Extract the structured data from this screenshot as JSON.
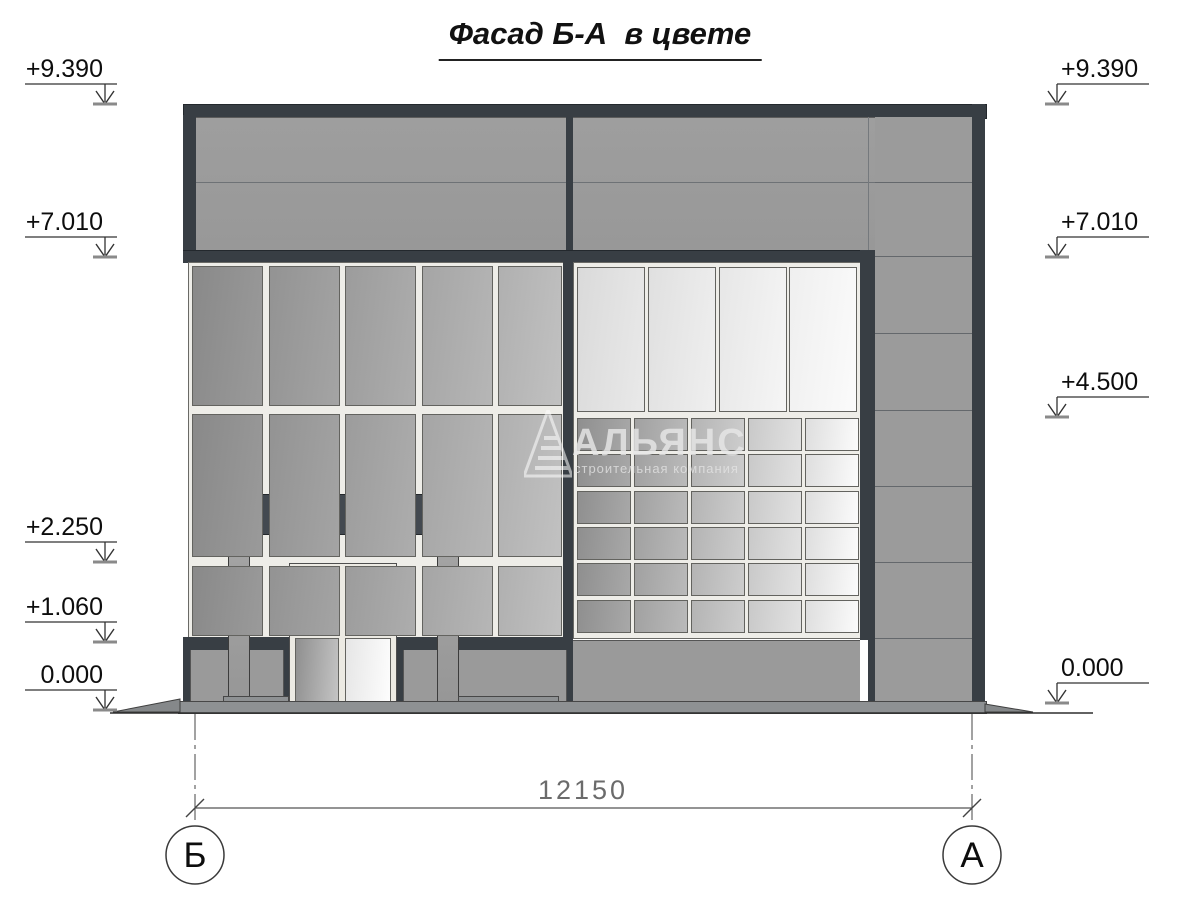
{
  "title": "Фасад Б-А  в цвете",
  "watermark": {
    "name": "АЛЬЯНС",
    "subtitle": "строительная компания"
  },
  "levels_left": [
    {
      "label": "+9.390",
      "y": 104
    },
    {
      "label": "+7.010",
      "y": 257
    },
    {
      "label": "+2.250",
      "y": 562
    },
    {
      "label": "+1.060",
      "y": 642
    },
    {
      "label": "0.000",
      "y": 710
    }
  ],
  "levels_right": [
    {
      "label": "+9.390",
      "y": 104
    },
    {
      "label": "+7.010",
      "y": 257
    },
    {
      "label": "+4.500",
      "y": 417
    },
    {
      "label": "0.000",
      "y": 703
    }
  ],
  "dimension": {
    "value": "12150"
  },
  "axes": [
    {
      "label": "Б",
      "x": 195
    },
    {
      "label": "А",
      "x": 972
    }
  ],
  "palette": {
    "frame_dark": "#383e44",
    "panel_gray": "#9c9c9c",
    "mullion": "#eeede8",
    "glass_white": "#f8f8f8",
    "beam_dark": "#434950",
    "line": "#333333"
  },
  "facade": {
    "left_grid": {
      "cols_x": [
        192,
        268.6,
        345.2,
        421.8,
        498.4
      ],
      "col_w": [
        69,
        69,
        69,
        69,
        62
      ],
      "rows": [
        {
          "y": 266,
          "h": 138
        },
        {
          "y": 414,
          "h": 141
        },
        {
          "y": 566,
          "h": 68
        }
      ],
      "col_colors": [
        [
          "#898989",
          "#9a9a9a"
        ],
        [
          "#939393",
          "#a4a4a4"
        ],
        [
          "#9c9c9c",
          "#adadad"
        ],
        [
          "#a5a5a5",
          "#b6b6b6"
        ],
        [
          "#b0b0b0",
          "#c1c1c1"
        ]
      ]
    },
    "right_tall": {
      "y": 267,
      "h": 143,
      "xs": [
        577,
        647.75,
        718.5,
        789.25
      ],
      "w": 66,
      "colors": [
        [
          "#dadada",
          "#e9e9e9"
        ],
        [
          "#e0e0e0",
          "#efefef"
        ],
        [
          "#e7e7e7",
          "#f5f5f5"
        ],
        [
          "#efefef",
          "#fbfbfb"
        ]
      ]
    },
    "right_small": {
      "row_ys": [
        418,
        454.3,
        490.6,
        526.9,
        563.2,
        599.5
      ],
      "h": 31,
      "xs": [
        577,
        634,
        691,
        748,
        805
      ],
      "w": 52,
      "colors": [
        [
          "#8f8f8f",
          "#a8a8a8"
        ],
        [
          "#a1a1a1",
          "#bababa"
        ],
        [
          "#b4b4b4",
          "#cdcdcd"
        ],
        [
          "#c9c9c9",
          "#e2e2e2"
        ],
        [
          "#dedede",
          "#fbfbfb"
        ]
      ]
    },
    "right_column_divider_ys": [
      182,
      256,
      333,
      410,
      486,
      562,
      638
    ]
  }
}
